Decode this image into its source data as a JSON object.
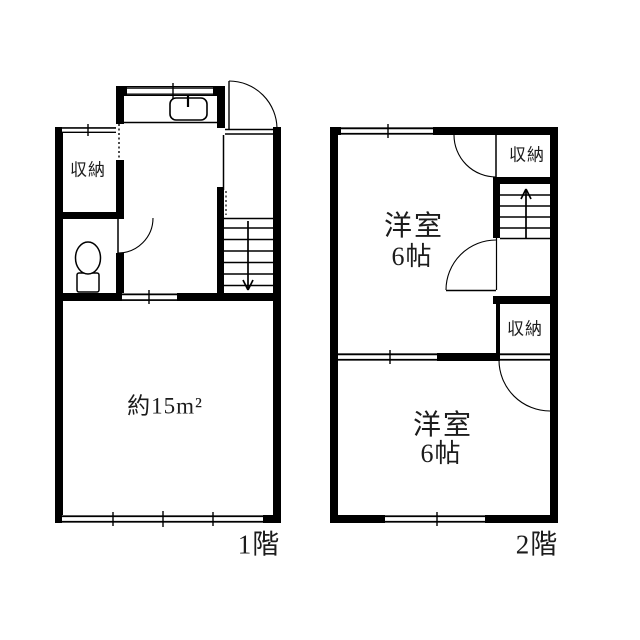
{
  "page": {
    "background_color": "#ffffff",
    "line_color": "#000000",
    "text_color": "#1c1c1c"
  },
  "icons": {
    "stairs_first_floor": "stairs-down-icon",
    "stairs_second_floor": "stairs-up-icon",
    "kitchen_sink": "kitchen-sink-icon",
    "toilet": "toilet-icon",
    "doors": "door-swing-icon",
    "windows": "window-icon"
  },
  "floor1": {
    "label": "1階",
    "storage_label": "収納",
    "main_room_area_label": "約15m²"
  },
  "floor2": {
    "label": "2階",
    "storage_top_label": "収納",
    "storage_middle_label": "収納",
    "room_top": {
      "name": "洋室",
      "size": "6帖"
    },
    "room_bottom": {
      "name": "洋室",
      "size": "6帖"
    }
  }
}
